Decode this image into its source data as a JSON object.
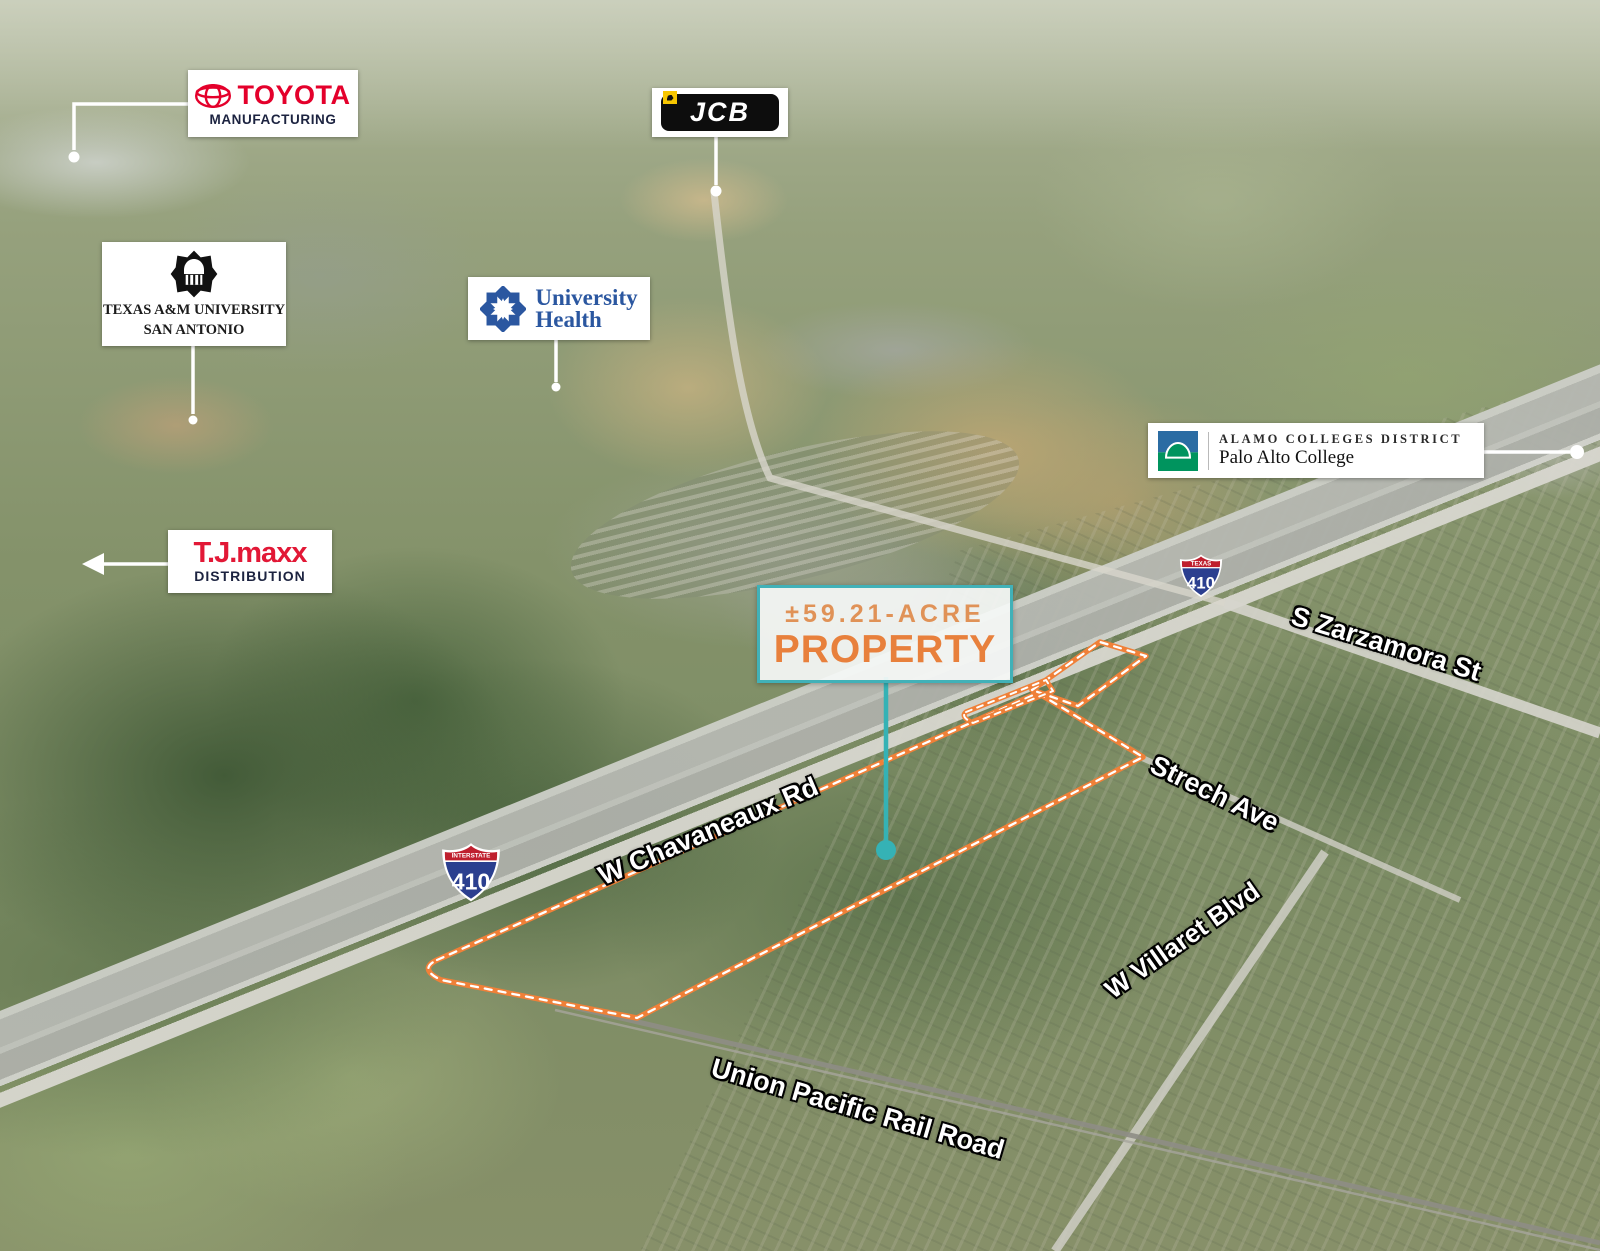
{
  "map": {
    "title": "±59.21-acre property aerial map, San Antonio TX",
    "property_label": {
      "acreage": "±59.21-ACRE",
      "title": "PROPERTY"
    },
    "landmarks": {
      "toyota": {
        "name": "TOYOTA",
        "sub": "MANUFACTURING"
      },
      "jcb": {
        "name": "JCB"
      },
      "tamusa": {
        "line1": "TEXAS A&M UNIVERSITY",
        "line2": "SAN ANTONIO"
      },
      "university_health": {
        "line1": "University",
        "line2": "Health"
      },
      "alamo": {
        "line1": "ALAMO COLLEGES DISTRICT",
        "line2": "Palo Alto College"
      },
      "tjmaxx": {
        "name": "T.J.maxx",
        "sub": "DISTRIBUTION"
      }
    },
    "roads": {
      "zarzamora": "S Zarzamora St",
      "strech": "Strech Ave",
      "chavaneaux": "W Chavaneaux Rd",
      "villaret": "W Villaret Blvd",
      "union_pacific": "Union Pacific Rail Road"
    },
    "shields": {
      "west": {
        "banner": "INTERSTATE",
        "route": "410"
      },
      "east": {
        "banner": "TEXAS",
        "route": "410"
      }
    },
    "colors": {
      "property_outline_orange": "#F08038",
      "marker_teal": "#35B2B5",
      "property_border_teal": "#41B1B8",
      "toyota_red": "#E4002B",
      "jcb_yellow": "#F7C600",
      "university_health_blue": "#2B57A0",
      "alamo_blue": "#2B6CA3",
      "alamo_green": "#00945E",
      "tjmaxx_red": "#E21836",
      "navy": "#1C2340",
      "interstate_blue": "#2B3F8F",
      "interstate_red": "#BF1F2E"
    }
  }
}
